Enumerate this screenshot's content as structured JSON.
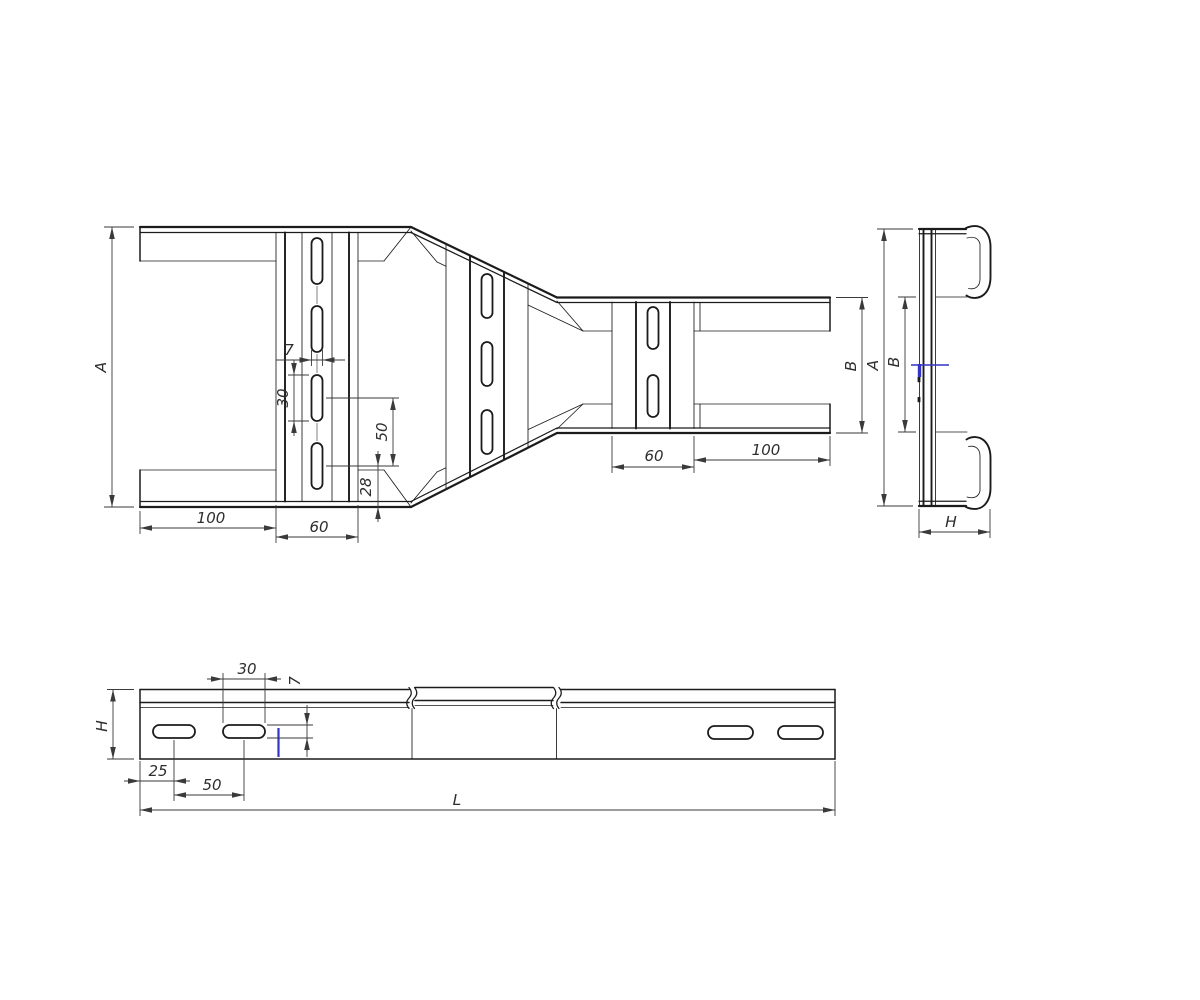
{
  "colors": {
    "background": "#ffffff",
    "linework": "#1b1b1b",
    "dimensions": "#3a3a3a",
    "accent_blue": "#3434c4"
  },
  "views": {
    "plan": {
      "overall_width": "A",
      "slot_width": "7",
      "slot_length": "30",
      "slot_pitch": "50",
      "slot_edge_offset": "28",
      "end_to_rung": "100",
      "rung_width_wide": "60",
      "rung_width_narrow": "60",
      "rung_to_end": "100",
      "narrow_width": "B"
    },
    "end": {
      "overall_width": "A",
      "inner_width": "B",
      "rail_depth": "H"
    },
    "side": {
      "rail_height": "H",
      "slot_length": "30",
      "slot_width": "7",
      "end_to_slot": "25",
      "slot_pitch": "50",
      "overall_length": "L"
    }
  }
}
